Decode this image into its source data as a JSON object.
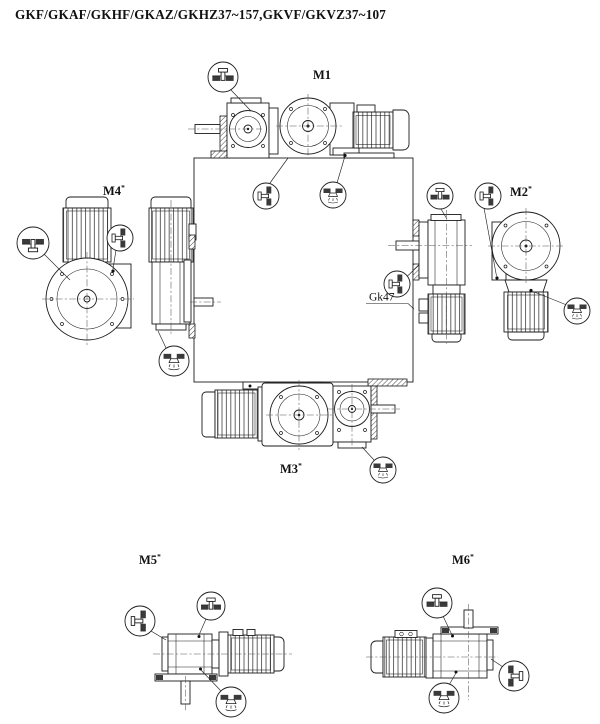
{
  "title": "GKF/GKAF/GKHF/GKAZ/GKHZ37~157,GKVF/GKVZ37~107",
  "positions": {
    "m1": {
      "label": "M1",
      "sup": ""
    },
    "m2": {
      "label": "M2",
      "sup": "*"
    },
    "m3": {
      "label": "M3",
      "sup": "*"
    },
    "m4": {
      "label": "M4",
      "sup": "*"
    },
    "m5": {
      "label": "M5",
      "sup": "*"
    },
    "m6": {
      "label": "M6",
      "sup": "*"
    }
  },
  "callouts": {
    "gk47": "Gk47"
  },
  "icons": {
    "vent_plug": "breather-vent-plug-icon",
    "oil_level_plug": "oil-level-plug-icon",
    "oil_drain_plug": "oil-drain-plug-icon"
  },
  "colors": {
    "line": "#1b1b1b",
    "background": "#ffffff"
  }
}
